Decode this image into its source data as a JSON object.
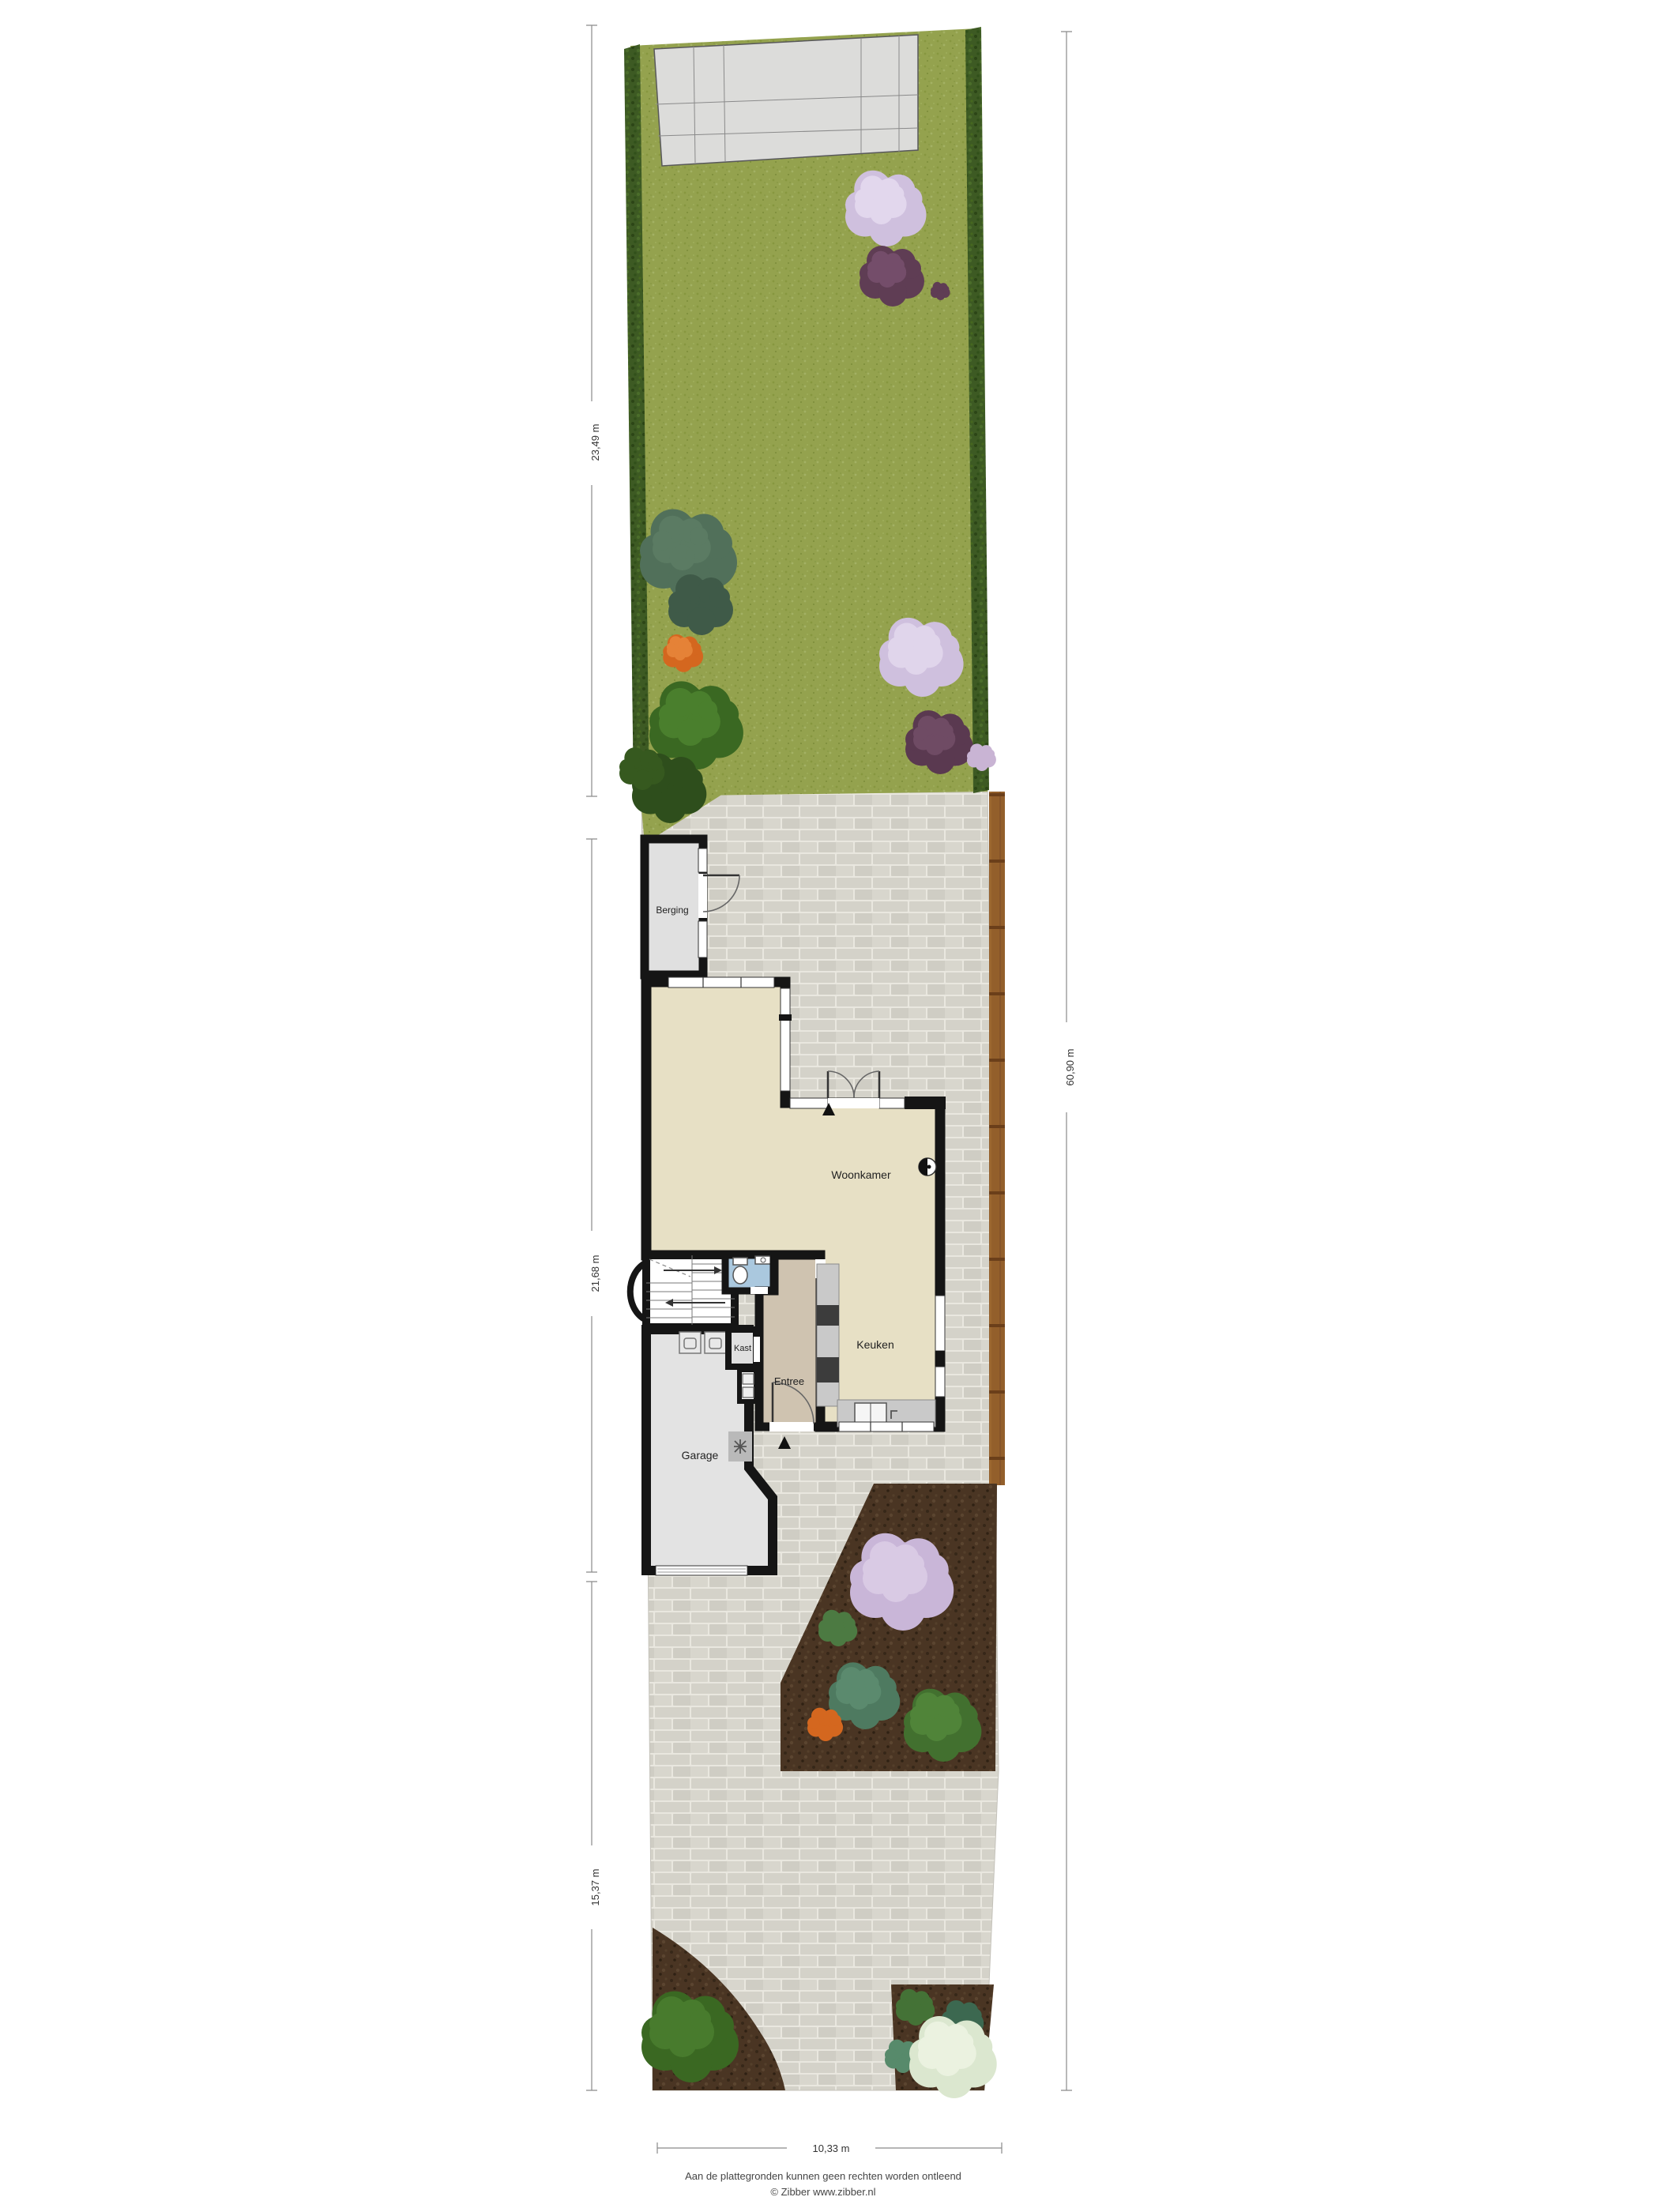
{
  "document": {
    "type": "Begane grond plattegrond met tuin (site plan)"
  },
  "rooms": {
    "berging": "Berging",
    "woonkamer": "Woonkamer",
    "keuken": "Keuken",
    "kast": "Kast",
    "entree": "Entree",
    "garage": "Garage"
  },
  "dimensions": {
    "garden": "23,49 m",
    "house": "21,68 m",
    "driveway": "15,37 m",
    "total_depth": "60,90 m",
    "total_width": "10,33 m"
  },
  "footer": {
    "disclaimer": "Aan de plattegronden kunnen geen rechten worden ontleend",
    "credit": "© Zibber www.zibber.nl"
  },
  "colors": {
    "wall": "#151515",
    "floor_living": "#e7e0c5",
    "floor_entree": "#cfc3b0",
    "floor_toilet": "#aac8de",
    "floor_garage": "#e3e3e3",
    "floor_berging": "#e0e0e0",
    "floor_kast": "#e0e0e0",
    "stairs": "#ffffff",
    "lawn": "#94a24e",
    "hedge": "#3d5a23",
    "brick_paving": "#d5d3ca",
    "patio_tiles": "#dcdcda",
    "fence": "#935f2b",
    "soil": "#4a3523",
    "counter": "#c9c9c9",
    "appliance_dark": "#3c3c3c"
  }
}
